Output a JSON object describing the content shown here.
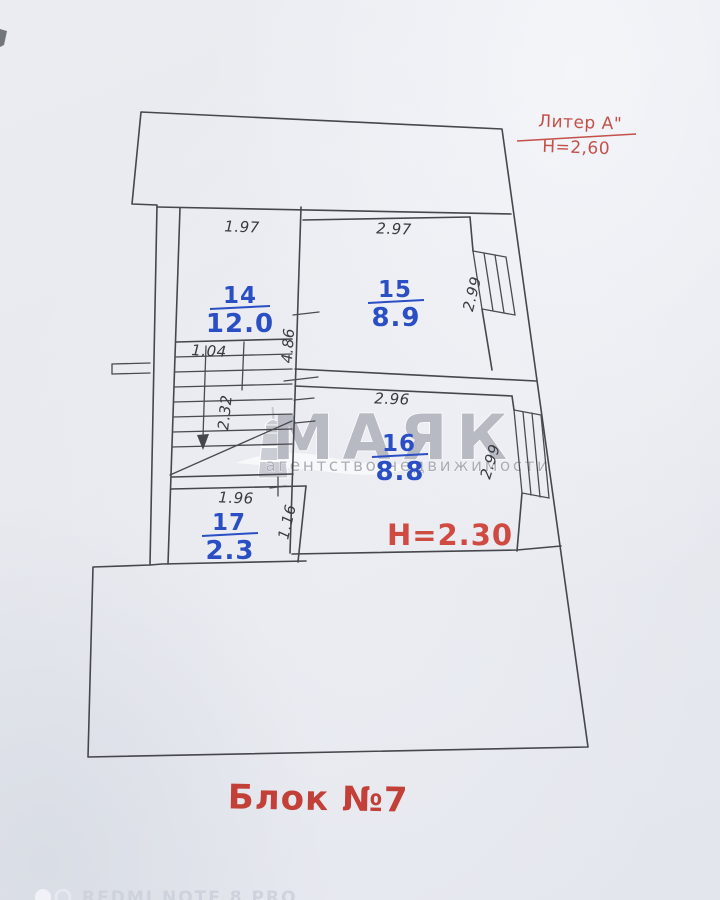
{
  "title_block": {
    "liter": "Литер А\"",
    "liter_height": "Н=2,60"
  },
  "plan": {
    "rooms": [
      {
        "number": "14",
        "area": "12.0"
      },
      {
        "number": "15",
        "area": "8.9"
      },
      {
        "number": "16",
        "area": "8.8"
      },
      {
        "number": "17",
        "area": "2.3"
      }
    ],
    "height_note": "Н=2.30",
    "block_label": "Блок №7",
    "dimensions": {
      "d197": "1.97",
      "d297": "2.97",
      "d299a": "2.99",
      "d486": "4.86",
      "d104": "1.04",
      "d232": "2.32",
      "d296": "2.96",
      "d299b": "2.99",
      "d196": "1.96",
      "d116": "1.16"
    }
  },
  "watermark": {
    "brand": "МАЯК",
    "tagline": "агентство недвижимости"
  },
  "camera": {
    "label": "REDMI NOTE 8 PRO"
  },
  "colors": {
    "room_label_blue": "#2a4fc4",
    "annotation_red": "#c5463c",
    "line_dark": "#45474c",
    "paper": "#e8eaef"
  }
}
